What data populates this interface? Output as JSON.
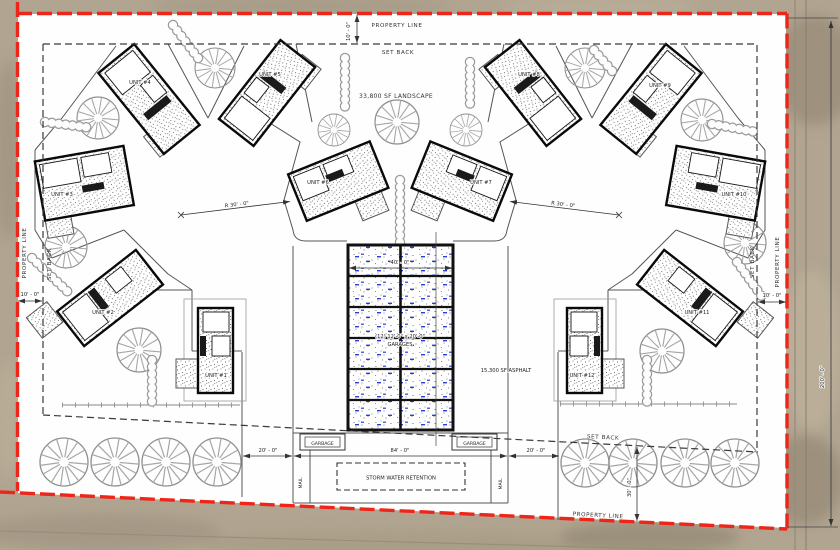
{
  "boundary": {
    "property_line_top": "PROPERTY LINE",
    "property_line_left": "PROPERTY LINE",
    "property_line_right": "PROPERTY LINE",
    "property_line_bottom": "PROPERTY LINE",
    "set_back_top": "SET BACK",
    "set_back_left": "SET BACK",
    "set_back_right": "SET BACK",
    "set_back_bottom": "SET BACK"
  },
  "areas": {
    "landscape": "33,800 SF LANDSCAPE",
    "asphalt": "15,300 SF ASPHALT",
    "storm_water": "STORM WATER RETENTION",
    "garages_line1": "(12) 12'-0\" x 20'-0\"",
    "garages_line2": "GARAGES",
    "garbage_left": "GARBAGE",
    "garbage_right": "GARBAGE",
    "mail_left": "MAIL",
    "mail_right": "MAIL"
  },
  "dimensions": {
    "top_offset": "10' - 0\"",
    "left_offset": "10' - 0\"",
    "right_offset": "10' - 0\"",
    "garage_width": "40' - 0\"",
    "court_width": "84' - 0\"",
    "apron_left": "20' - 0\"",
    "apron_right": "20' - 0\"",
    "rear_offset": "30' - 0\"",
    "east_depth": "200' - 0\"",
    "radius_left": "R 30' - 0\"",
    "radius_right": "R 30' - 0\""
  },
  "units": [
    {
      "label": "UNIT #1"
    },
    {
      "label": "UNIT #2"
    },
    {
      "label": "UNIT #3"
    },
    {
      "label": "UNIT #4"
    },
    {
      "label": "UNIT #5"
    },
    {
      "label": "UNIT #6"
    },
    {
      "label": "UNIT #7"
    },
    {
      "label": "UNIT #8"
    },
    {
      "label": "UNIT #9"
    },
    {
      "label": "UNIT #10"
    },
    {
      "label": "UNIT #11"
    },
    {
      "label": "UNIT #12"
    }
  ],
  "colors": {
    "property_line_red": "#ee2619",
    "garage_tick_blue": "#2b3fd4",
    "ground_tan": "#b1a591"
  }
}
